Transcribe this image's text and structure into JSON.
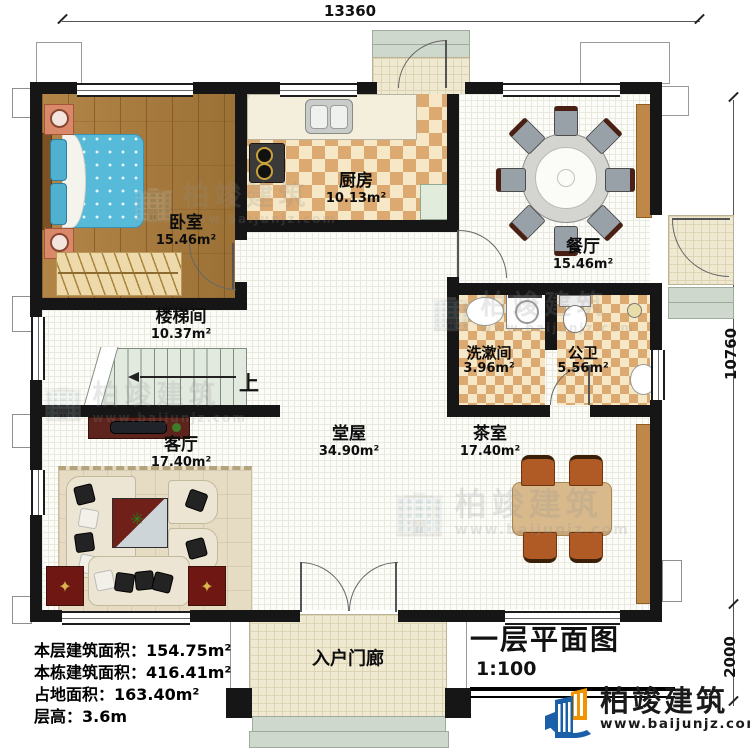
{
  "dimensions": {
    "width_top": "13360",
    "height_right": "10760",
    "porch_depth_right": "2000"
  },
  "rooms": [
    {
      "name": "卧室",
      "area": "15.46m²"
    },
    {
      "name": "厨房",
      "area": "10.13m²"
    },
    {
      "name": "餐厅",
      "area": "15.46m²"
    },
    {
      "name": "楼梯间",
      "area": "10.37m²"
    },
    {
      "name": "洗漱间",
      "area": "3.96m²"
    },
    {
      "name": "公卫",
      "area": "5.56m²"
    },
    {
      "name": "客厅",
      "area": "17.40m²"
    },
    {
      "name": "堂屋",
      "area": "34.90m²"
    },
    {
      "name": "茶室",
      "area": "17.40m²"
    },
    {
      "name": "入户门廊",
      "area": ""
    }
  ],
  "stairs": {
    "direction_label": "上"
  },
  "title_block": {
    "title": "一层平面图",
    "scale": "1:100"
  },
  "info_lines": [
    {
      "label": "本层建筑面积：",
      "value": "154.75m²"
    },
    {
      "label": "本栋建筑面积：",
      "value": "416.41m²"
    },
    {
      "label": "占地面积：",
      "value": "163.40m²"
    },
    {
      "label": "层高：",
      "value": "3.6m"
    }
  ],
  "brand": {
    "name": "柏竣建筑",
    "website": "www.baijunjz.com"
  },
  "watermark": {
    "name": "柏竣建筑",
    "website": "www.baijunjz.com",
    "icon": "🏢"
  },
  "icons": {
    "plant": "✳",
    "star": "✦"
  },
  "colors": {
    "wall": "#161616",
    "checker_tile": "#dcaa70",
    "wood_floor": "#aa7d40",
    "brand_blue": "#1a5fa8",
    "brand_orange": "#f29400"
  }
}
